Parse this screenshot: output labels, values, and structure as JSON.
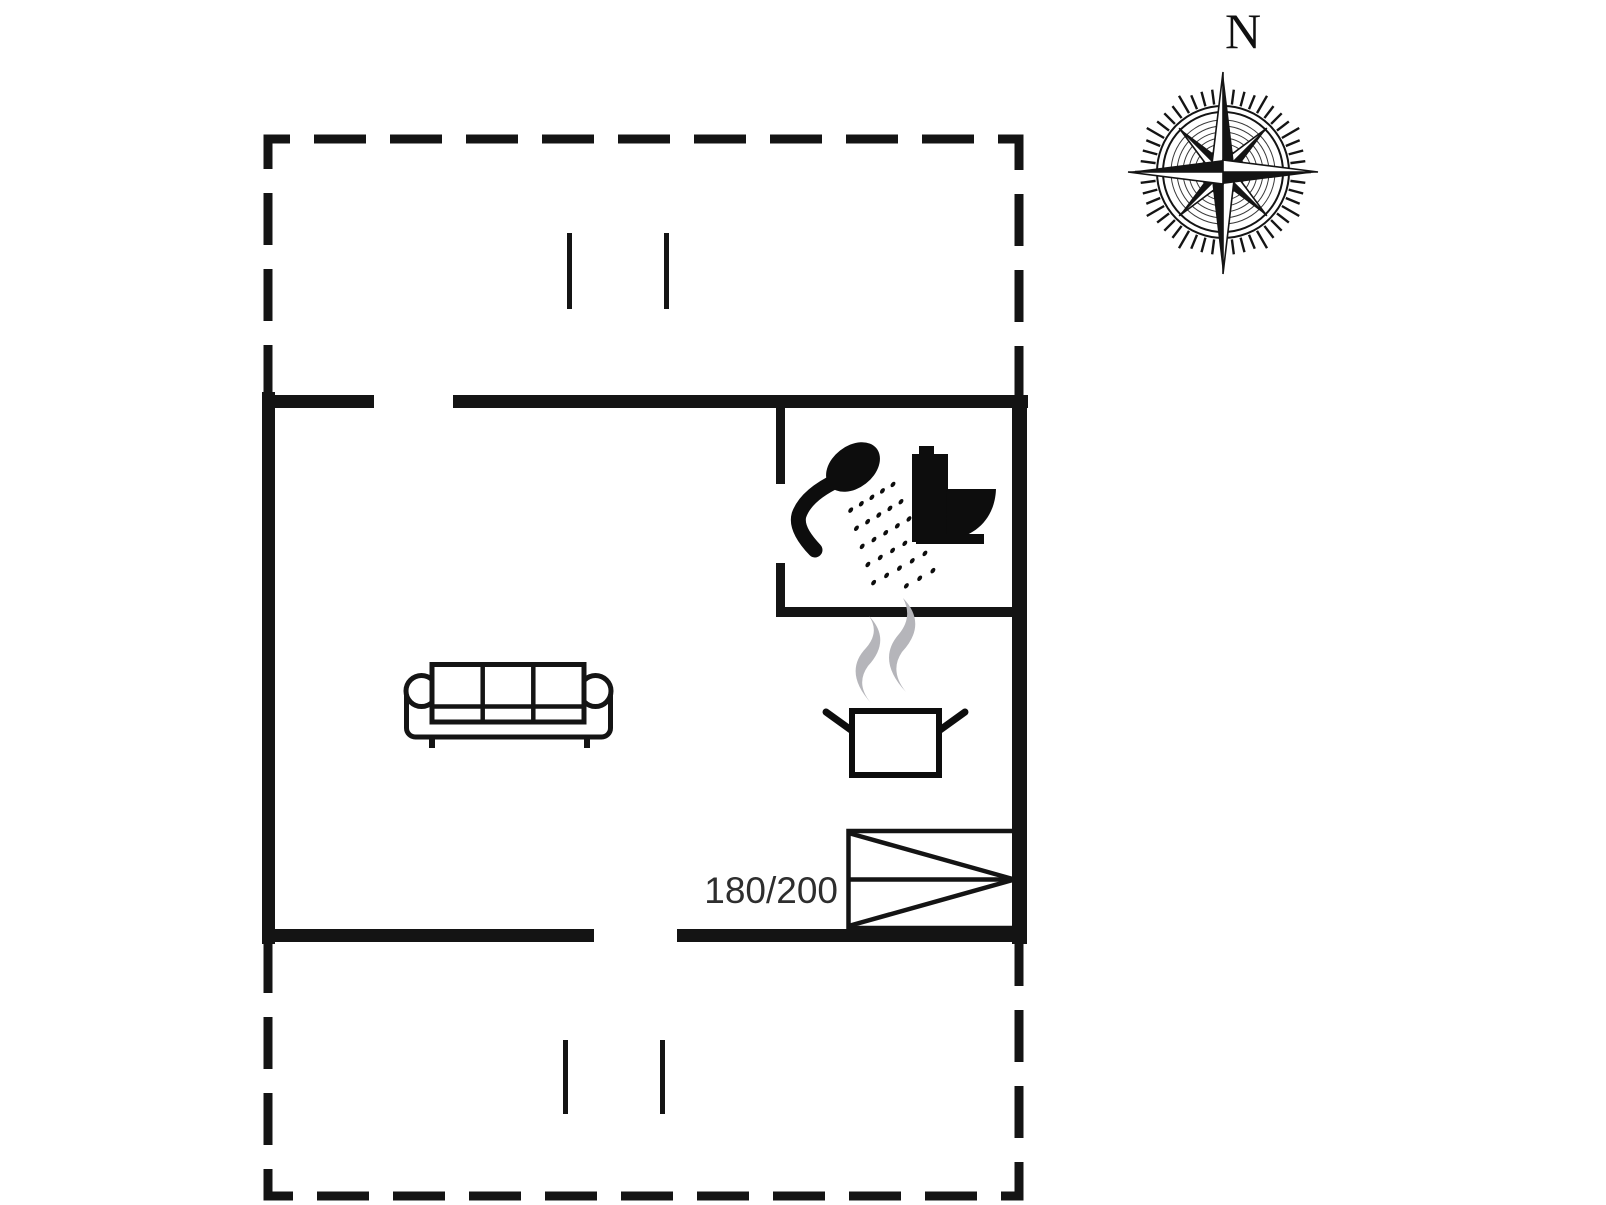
{
  "colors": {
    "wall": "#141414",
    "icon": "#0d0d0d",
    "steam": "#b5b5ba",
    "label": "#2e2e2e",
    "bg": "#ffffff"
  },
  "compass": {
    "label": "N"
  },
  "bed": {
    "size_label": "180/200"
  },
  "icons": {
    "compass": "compass-rose-icon",
    "sofa": "sofa-icon",
    "cooking_pot": "cooking-pot-icon",
    "steam": "steam-icon",
    "shower": "shower-icon",
    "toilet": "toilet-icon",
    "double_bed": "double-bed-icon"
  }
}
